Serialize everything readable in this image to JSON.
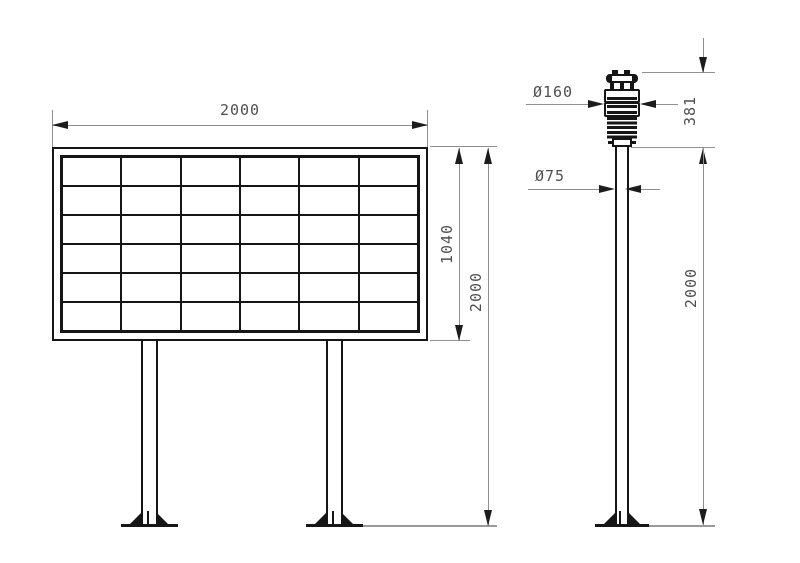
{
  "front_view": {
    "width_dim": "2000",
    "board_height_dim": "1040",
    "overall_height_dim": "2000",
    "grid_rows": 6,
    "grid_cols": 6
  },
  "side_view": {
    "sensor_diameter_dim": "Ø160",
    "sensor_height_dim": "381",
    "pole_diameter_dim": "Ø75",
    "pole_height_dim": "2000"
  },
  "colors": {
    "object_line": "#161616",
    "dimension_line": "#8f8f8f",
    "text": "#4f4f4f",
    "background": "#ffffff"
  }
}
